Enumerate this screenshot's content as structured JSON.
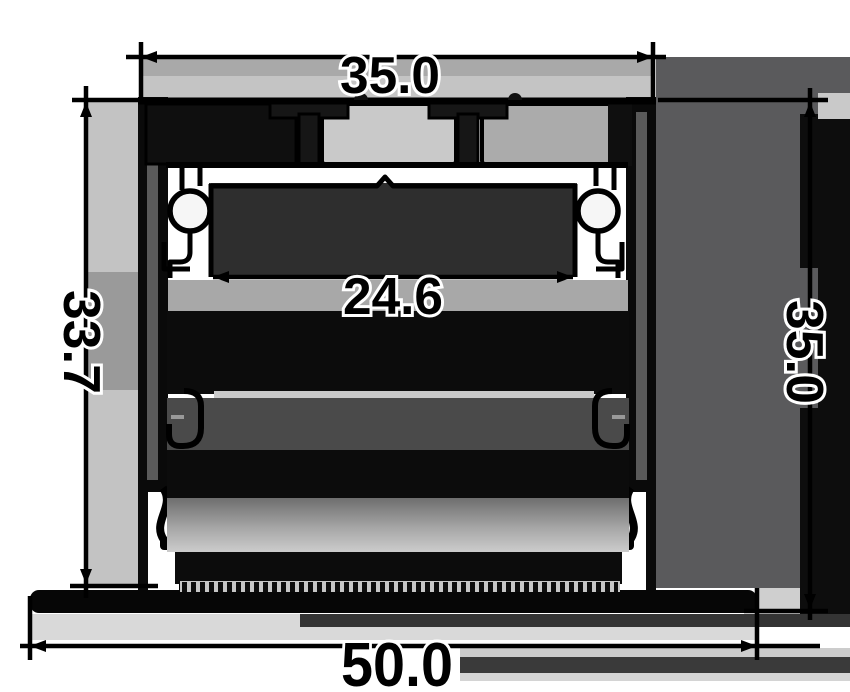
{
  "page": {
    "background": "#ffffff"
  },
  "drawing": {
    "description": "extrusion profile cross-section drawing",
    "line_color": "#000000",
    "shading": {
      "panel_dark": "#5a5a5c",
      "panel_black": "#0d0d0d",
      "panel_light": "#c4c4c4",
      "cavity_dark": "#2e2e2e",
      "band_mid": "#a8a8a8",
      "bottom_light": "#d9d9d9"
    },
    "dimensions": {
      "top_width": {
        "label": "35.0"
      },
      "inner_width": {
        "label": "24.6"
      },
      "left_height": {
        "label": "33.7"
      },
      "right_height": {
        "label": "35.0"
      },
      "overall_width": {
        "label": "50.0"
      }
    }
  }
}
